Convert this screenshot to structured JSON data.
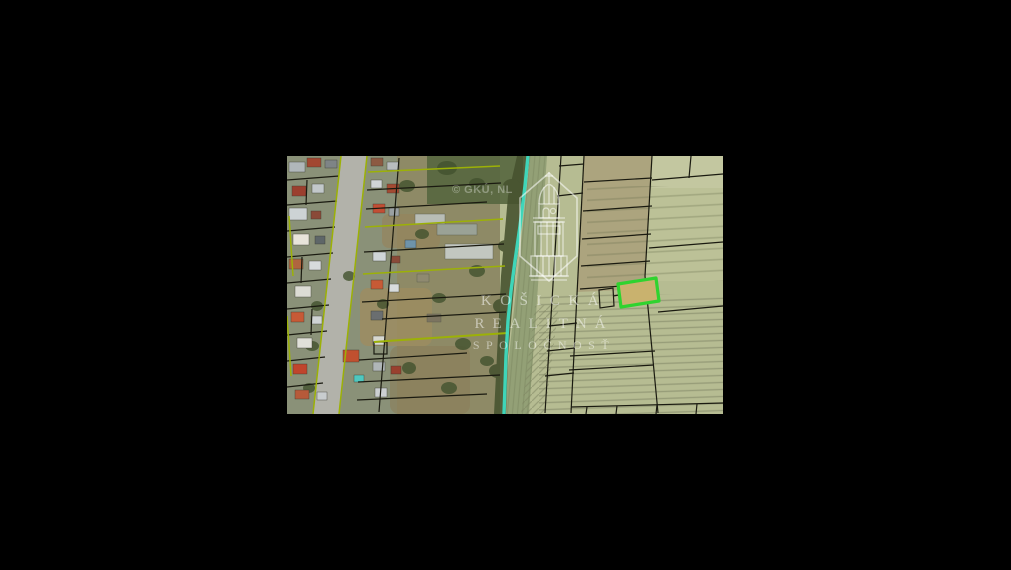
{
  "frame": {
    "background": "#000000"
  },
  "map": {
    "copyright_text": "© GKÚ, NL",
    "watermark": {
      "line1": "KOŠICKÁ",
      "line2": "REALITNÁ",
      "line3": "SPOLOČNOSŤ",
      "color": "#ffffff"
    },
    "colors": {
      "highlight_stroke": "#2fd32f",
      "highlight_fill": "#c9b26e",
      "boundary_teal": "#3ee0c4",
      "cadastral_black": "#1a1a10",
      "cadastral_yellow": "#9cb106",
      "field_base": "#b6bc92",
      "field_light": "#c3c7a0",
      "field_column": "#aca47e",
      "garden_base": "#8e8a66",
      "residential_base": "#8a9178",
      "road_fill": "#b2b2aa",
      "verge_green": "#93a076",
      "tree_dark": "#46522f"
    }
  }
}
